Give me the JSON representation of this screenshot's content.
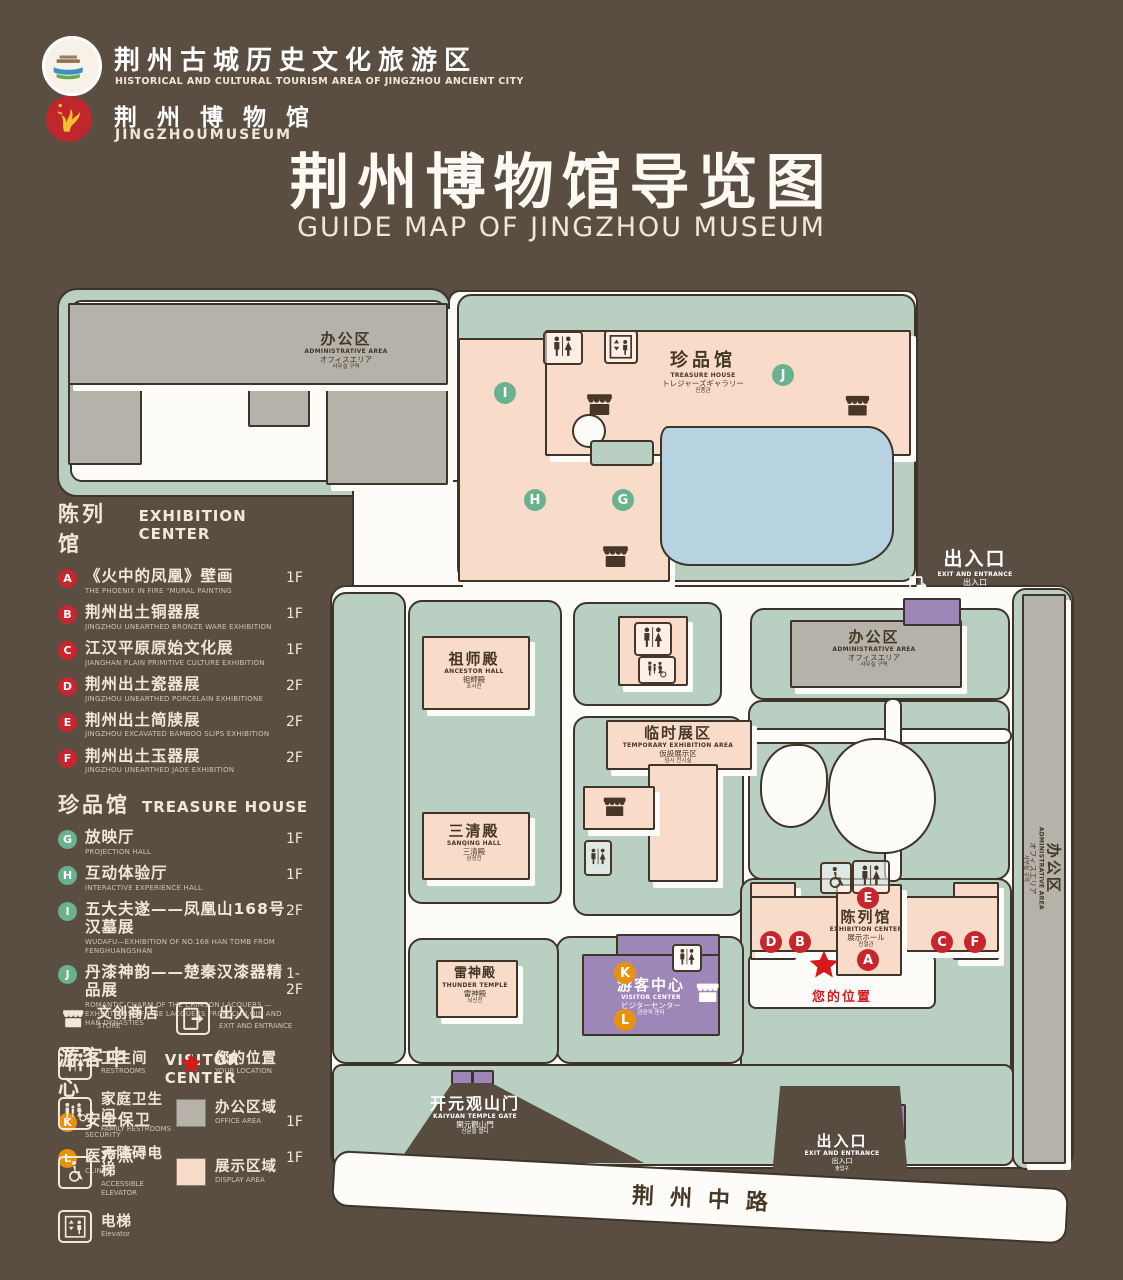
{
  "header": {
    "org1_zh": "荆州古城历史文化旅游区",
    "org1_en": "HISTORICAL AND CULTURAL TOURISM AREA OF JINGZHOU ANCIENT CITY",
    "org2_zh": "荆 州 博 物 馆",
    "org2_en": "JINGZHOUMUSEUM",
    "title_zh": "荆州博物馆导览图",
    "title_en": "GUIDE MAP OF JINGZHOU MUSEUM"
  },
  "legend": {
    "sections": [
      {
        "zh": "陈列馆",
        "en": "EXHIBITION CENTER",
        "items": [
          {
            "letter": "A",
            "zh": "《火中的凤凰》壁画",
            "en": "THE PHOENIX IN FIRE \"MURAL PAINTING",
            "floor": "1F"
          },
          {
            "letter": "B",
            "zh": "荆州出土铜器展",
            "en": "JINGZHOU UNEARTHED BRONZE WARE EXHIBITION",
            "floor": "1F"
          },
          {
            "letter": "C",
            "zh": "江汉平原原始文化展",
            "en": "JIANGHAN PLAIN PRIMITIVE CULTURE EXHIBITION",
            "floor": "1F"
          },
          {
            "letter": "D",
            "zh": "荆州出土瓷器展",
            "en": "JINGZHOU UNEARTHED PORCELAIN EXHIBITIONE",
            "floor": "2F"
          },
          {
            "letter": "E",
            "zh": "荆州出土简牍展",
            "en": "JINGZHOU EXCAVATED BAMBOO SLIPS EXHIBITION",
            "floor": "2F"
          },
          {
            "letter": "F",
            "zh": "荆州出土玉器展",
            "en": "JINGZHOU UNEARTHED JADE EXHIBITION",
            "floor": "2F"
          }
        ]
      },
      {
        "zh": "珍品馆",
        "en": "TREASURE HOUSE",
        "items": [
          {
            "letter": "G",
            "zh": "放映厅",
            "en": "PROJECTION HALL",
            "floor": "1F"
          },
          {
            "letter": "H",
            "zh": "互动体验厅",
            "en": "INTERACTIVE EXPERIENCE HALL",
            "floor": "1F"
          },
          {
            "letter": "I",
            "zh": "五大夫遂——凤凰山168号汉墓展",
            "en": "WUDAFU—EXHIBITION OF NO.168 HAN TOMB FROM FENGHUANGSHAN",
            "floor": "2F"
          },
          {
            "letter": "J",
            "zh": "丹漆神韵——楚秦汉漆器精品展",
            "en": "ROMANTIC CHARM OF THE CRIMSON LACQUERS —EXHIBITIONS OF FINE LACQUERS FROM CHU,QIN AND HAN DYNASTIES",
            "floor": "1-2F"
          }
        ]
      },
      {
        "zh": "游客中心",
        "en": "VISITOR CENTER",
        "items": [
          {
            "letter": "K",
            "zh": "安全保卫",
            "en": "SECURITY",
            "floor": "1F"
          },
          {
            "letter": "L",
            "zh": "医疗点",
            "en": "CLINIC",
            "floor": "1F"
          }
        ]
      }
    ],
    "icons": [
      {
        "zh": "文创商店",
        "en": "STORE"
      },
      {
        "zh": "出入口",
        "en": "EXIT AND ENTRANCE"
      },
      {
        "zh": "卫生间",
        "en": "RESTROOMS"
      },
      {
        "zh": "您的位置",
        "en": "YOUR LOCATION"
      },
      {
        "zh": "家庭卫生间",
        "en": "FAMILY RESTROOMS"
      },
      {
        "zh": "办公区域",
        "en": "OFFICE AREA"
      },
      {
        "zh": "无障碍电梯",
        "en": "ACCESSIBLE ELEVATOR"
      },
      {
        "zh": "展示区域",
        "en": "DISPLAY AREA"
      },
      {
        "zh": "电梯",
        "en": "Elevator"
      }
    ]
  },
  "map": {
    "admin": {
      "zh": "办公区",
      "en": "ADMINISTRATIVE AREA",
      "ja": "オフィスエリア",
      "ko": "사무실 구역"
    },
    "treasure": {
      "zh": "珍品馆",
      "en": "TREASURE HOUSE",
      "ja": "トレジャーズギャラリー",
      "ko": "진품관"
    },
    "ancestor": {
      "zh": "祖师殿",
      "en": "ANCESTOR HALL",
      "ja": "祖師殿",
      "ko": "조사전"
    },
    "sanqing": {
      "zh": "三清殿",
      "en": "SANQING HALL",
      "ja": "三清殿",
      "ko": "삼청전"
    },
    "temporary": {
      "zh": "临时展区",
      "en": "TEMPORARY EXHIBITION AREA",
      "ja": "仮設展示区",
      "ko": "임시 전시실"
    },
    "exhibition": {
      "zh": "陈列馆",
      "en": "EXHIBITION CENTER",
      "ja": "展示ホール",
      "ko": "진열관"
    },
    "thunder": {
      "zh": "雷神殿",
      "en": "THUNDER TEMPLE",
      "ja": "雷神殿",
      "ko": "뇌신전"
    },
    "visitor": {
      "zh": "游客中心",
      "en": "VISITOR CENTER",
      "ja": "ビジターセンター",
      "ko": "관광객 센터"
    },
    "gate": {
      "zh": "开元观山门",
      "en": "KAIYUAN TEMPLE GATE",
      "ja": "開元觀山門",
      "ko": "산문을 열다"
    },
    "exit": {
      "zh": "出入口",
      "en": "EXIT AND ENTRANCE",
      "ja": "出入口",
      "ko": "출입구"
    },
    "road_zh": "荆州中路",
    "your_location_zh": "您的位置",
    "markers": [
      "A",
      "B",
      "C",
      "D",
      "E",
      "F",
      "G",
      "H",
      "I",
      "J",
      "K",
      "L"
    ]
  },
  "colors": {
    "background": "#5a4e43",
    "map_green": "#b9cfc2",
    "building_pink": "#f8dcc9",
    "building_gray": "#b5b2a9",
    "pond_blue": "#b7d3e2",
    "visitor_purple": "#9d86b8",
    "badge_red": "#c8262e",
    "badge_green": "#6ab28e",
    "badge_orange": "#e8920c",
    "location_red": "#d8191f"
  }
}
